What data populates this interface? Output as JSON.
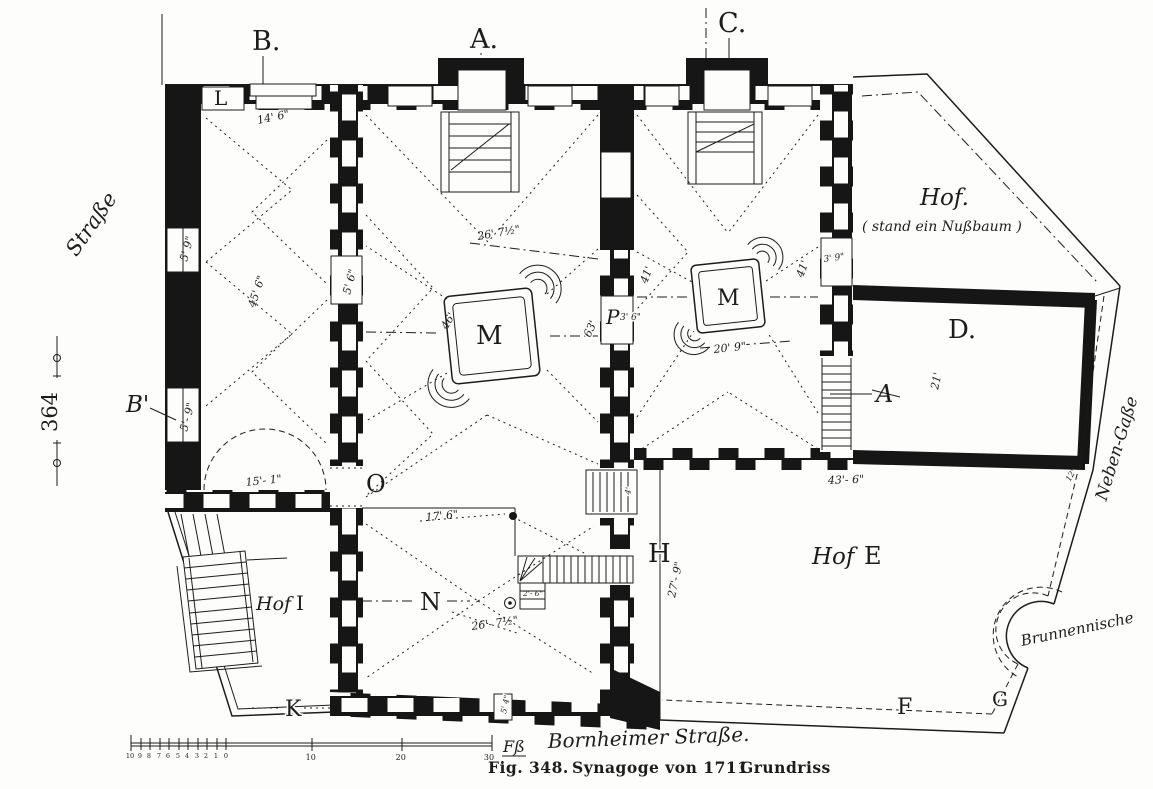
{
  "figure": {
    "page_number": "364",
    "caption": {
      "fig_label": "Fig. 348.",
      "title": "Synagoge von 1711",
      "plan_type": "Grundriss"
    }
  },
  "streets": {
    "left": "Straße",
    "bottom": "Bornheimer Straße.",
    "right": "Neben-Gaße"
  },
  "sections": {
    "a": "A.",
    "b": "B.",
    "c": "C."
  },
  "rooms": {
    "l": "L",
    "b_prime": "B'",
    "o": "O",
    "m_main": "M",
    "m_east": "M",
    "p": "P",
    "d": "D.",
    "h": "H",
    "n": "N",
    "k": "K",
    "f": "F",
    "g": "G",
    "a_stairs": "A"
  },
  "courtyards": {
    "hof_top": {
      "name": "Hof.",
      "note": "( stand ein Nußbaum )"
    },
    "hof_e": {
      "prefix": "Hof",
      "letter": "E"
    },
    "hof_i": {
      "prefix": "Hof",
      "letter": "I"
    },
    "well_niche": "Brunnennische"
  },
  "dimensions": {
    "w14_6": "14' 6\"",
    "w5_9_upper": "5' 9\"",
    "l45_6": "45' 6\"",
    "w5_6": "5' 6\"",
    "w5_9_lower": "5'- 9\"",
    "w15_1": "15'- 1\"",
    "c26_7": "26' 7½\"",
    "c46": "46'",
    "c63": "63'",
    "p3_6": "3' 6\"",
    "e41_west": "41'",
    "e41_east": "41'",
    "e3_9": "3' 9\"",
    "e20_9": "20' 9\"",
    "d21": "21'",
    "d43_6": "43'- 6\"",
    "d12": "12'",
    "n17_6": "17' 6\"",
    "n26_7": "26'- 7½\"",
    "n2_6": "2'- 6\"",
    "h27_9": "27'- 9\"",
    "b5_4": "5' 4\"",
    "s4": "4'"
  },
  "scale_bar": {
    "minor": [
      "10",
      "9",
      "8",
      "7",
      "6",
      "5",
      "4",
      "3",
      "2",
      "1",
      "0"
    ],
    "major": [
      "10",
      "20",
      "30"
    ],
    "unit": "Fß"
  }
}
